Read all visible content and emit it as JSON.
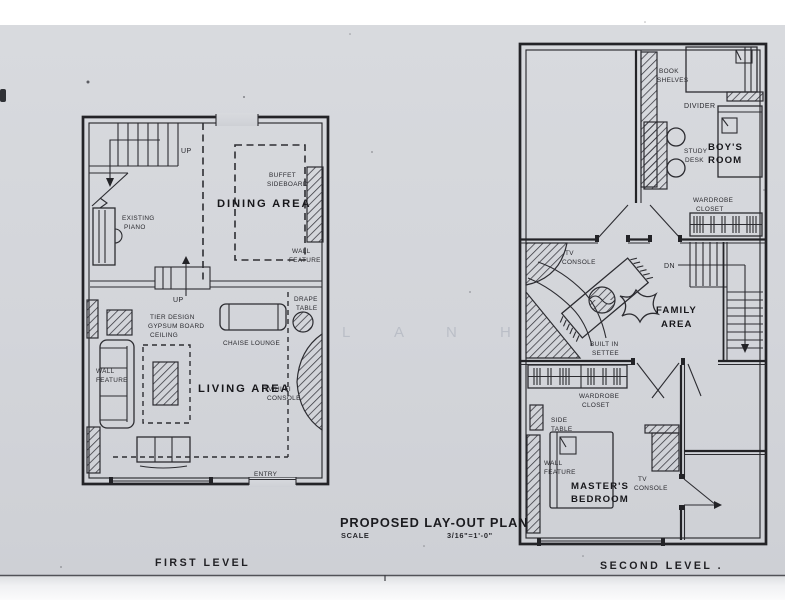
{
  "photo": {
    "paper_color": "#d3d5da",
    "ink_color": "#232327",
    "top_strip_color": "#ffffff",
    "bottom_strip_color": "#edeff2"
  },
  "title_block": {
    "title": "PROPOSED LAY-OUT PLAN",
    "scale_label": "SCALE",
    "scale_value": "3/16\"=1'-0\""
  },
  "watermark": [
    "L",
    "A",
    "N",
    "H"
  ],
  "first_level": {
    "caption": "FIRST LEVEL",
    "rooms": {
      "dining": "DINING AREA",
      "living": "LIVING AREA"
    },
    "labels": {
      "up_stairs": "UP",
      "existing_piano": [
        "EXISTING",
        "PIANO"
      ],
      "buffet": [
        "BUFFET",
        "SIDEBOARD"
      ],
      "wall_feature_right": [
        "WALL",
        "FEATURE"
      ],
      "up_steps": "UP",
      "drape_table": [
        "DRAPE",
        "TABLE"
      ],
      "tier_ceiling": [
        "TIER DESIGN",
        "GYPSUM BOARD",
        "CEILING"
      ],
      "chaise": "CHAISE LOUNGE",
      "wall_feature_left": [
        "WALL",
        "FEATURE"
      ],
      "tv_hifi": [
        "TV/HI-FI",
        "CONSOLE"
      ],
      "entry": "ENTRY"
    }
  },
  "second_level": {
    "caption": "SECOND LEVEL .",
    "rooms": {
      "boys": [
        "BOY'S",
        "ROOM"
      ],
      "family": [
        "FAMILY",
        "AREA"
      ],
      "master": [
        "MASTER'S",
        "BEDROOM"
      ]
    },
    "labels": {
      "book_shelves": [
        "BOOK",
        "SHELVES"
      ],
      "divider": "DIVIDER",
      "study_desk": [
        "STUDY",
        "DESK"
      ],
      "wardrobe_top": [
        "WARDROBE",
        "CLOSET"
      ],
      "tv_console_family": [
        "TV",
        "CONSOLE"
      ],
      "dn": "DN",
      "built_in_settee": [
        "BUILT IN",
        "SETTEE"
      ],
      "wardrobe_master": [
        "WARDROBE",
        "CLOSET"
      ],
      "side_table": [
        "SIDE",
        "TABLE"
      ],
      "wall_feature": [
        "WALL",
        "FEATURE"
      ],
      "tv_console_master": [
        "TV",
        "CONSOLE"
      ]
    }
  }
}
